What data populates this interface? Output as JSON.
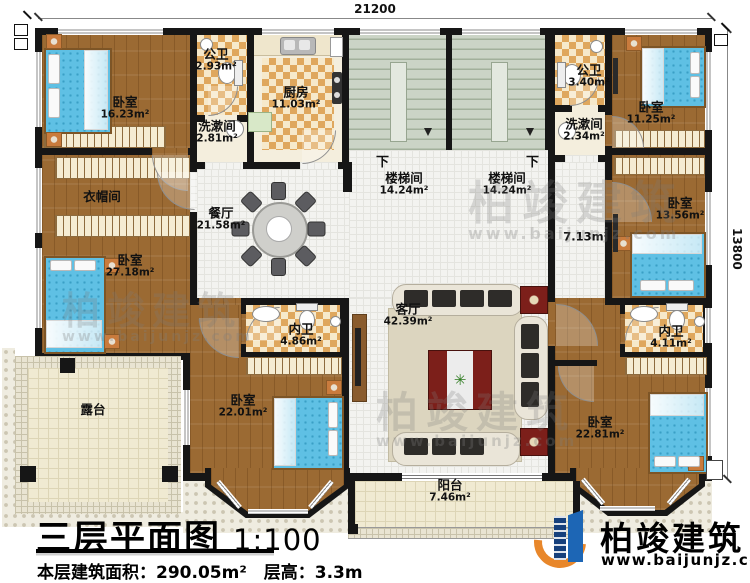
{
  "title_block": {
    "title": "三层平面图",
    "scale": "1:100",
    "area_line": "本层建筑面积：290.05m²　层高：3.3m"
  },
  "brand": {
    "name": "柏竣建筑",
    "url": "www.baijunjz.com"
  },
  "watermark": {
    "name": "柏竣建筑",
    "url": "www.baijunjz.com"
  },
  "dimensions": {
    "top": "21200",
    "right": "13800"
  },
  "stair_down_label": "下",
  "rooms": [
    {
      "name": "卧室",
      "area": "16.23m²"
    },
    {
      "name": "公卫",
      "area": "2.93m²"
    },
    {
      "name": "洗漱间",
      "area": "2.81m²"
    },
    {
      "name": "厨房",
      "area": "11.03m²"
    },
    {
      "name": "楼梯间",
      "area": "14.24m²"
    },
    {
      "name": "楼梯间",
      "area": "14.24m²"
    },
    {
      "name": "公卫",
      "area": "3.40m²"
    },
    {
      "name": "洗漱间",
      "area": "2.34m²"
    },
    {
      "name": "卧室",
      "area": "11.25m²"
    },
    {
      "name": "衣帽间",
      "area": ""
    },
    {
      "name": "卧室",
      "area": "27.18m²"
    },
    {
      "name": "餐厅",
      "area": "21.58m²"
    },
    {
      "name": "",
      "area": "7.13m²"
    },
    {
      "name": "卧室",
      "area": "13.56m²"
    },
    {
      "name": "客厅",
      "area": "42.39m²"
    },
    {
      "name": "内卫",
      "area": "4.86m²"
    },
    {
      "name": "内卫",
      "area": "4.11m²"
    },
    {
      "name": "露台",
      "area": ""
    },
    {
      "name": "卧室",
      "area": "22.01m²"
    },
    {
      "name": "卧室",
      "area": "22.81m²"
    },
    {
      "name": "阳台",
      "area": "7.46m²"
    }
  ],
  "colors": {
    "wall": "#161616",
    "wood_floor": "#9b6a33",
    "tile_checker": "#dfa75d",
    "bed_blue": "#5fc0e4",
    "stair_green": "#cbd4c6",
    "brand_blue": "#1d66b5",
    "brand_orange": "#e8872b"
  }
}
